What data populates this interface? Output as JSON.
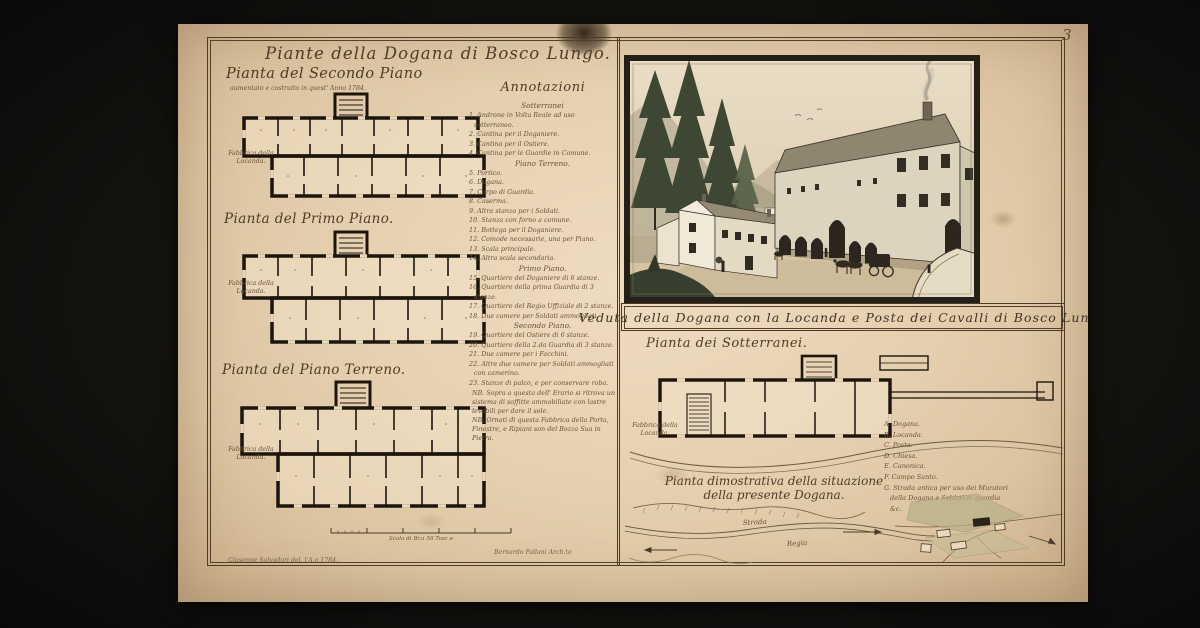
{
  "colors": {
    "backdrop": "#141310",
    "paper": "#e6d2b2",
    "ink": "#1b150e",
    "handwriting": "#6b5136",
    "wash_green": "#3e4634"
  },
  "page": {
    "number": "3"
  },
  "left_panel": {
    "main_title": "Piante della Dogana di Bosco Lungo.",
    "secondo": {
      "title": "Pianta del Secondo Piano",
      "subtitle": "aumentato e costruito in quest' Anno 1784.",
      "margin_label": "Fabbrica della Locanda."
    },
    "primo": {
      "title": "Pianta del Primo Piano.",
      "margin_label": "Fabbrica della Locanda."
    },
    "terreno": {
      "title": "Pianta del Piano Terreno.",
      "margin_label": "Fabbrica della Locanda."
    },
    "annotazioni": {
      "heading": "Annotazioni",
      "lines": [
        {
          "text": "Sotterranei"
        },
        {
          "text": "1. Androne in Volta Reale ad uso sotterraneo."
        },
        {
          "text": "2. Cantina per il Doganiere."
        },
        {
          "text": "3. Cantina per il Ostiere."
        },
        {
          "text": "4. Cantina per le Guardie in Comune."
        },
        {
          "text": "Piano Terreno."
        },
        {
          "text": "5. Portico."
        },
        {
          "text": "6. Dogana."
        },
        {
          "text": "7. Corpo di Guardia."
        },
        {
          "text": "8. Caserma."
        },
        {
          "text": "9. Altra stanza per i Soldati."
        },
        {
          "text": "10. Stanza con forno a comune."
        },
        {
          "text": "11. Bottega per il Doganiere."
        },
        {
          "text": "12. Comode necessarie, una per Piano."
        },
        {
          "text": "13. Scala principale."
        },
        {
          "text": "14. Altra scala secondaria."
        },
        {
          "text": "Primo Piano."
        },
        {
          "text": "15. Quartiere del Doganiere di 6 stanze."
        },
        {
          "text": "16. Quartiere della prima Guardia di 3 stanze."
        },
        {
          "text": "17. Quartiere del Regio Uffiziale di 2 stanze."
        },
        {
          "text": "18. Due camere per Soldati ammogliati."
        },
        {
          "text": "Secondo Piano."
        },
        {
          "text": "19. Quartiere del Ostiere di 6 stanze."
        },
        {
          "text": "20. Quartiere della 2.da Guardia di 3 stanze."
        },
        {
          "text": "21. Due camere per i Facchini."
        },
        {
          "text": "22. Altre due camere per Soldati ammogliati con camerino."
        },
        {
          "text": "23. Stanze di palco, e per conservare roba."
        },
        {
          "text": "NB. Sopra a questa dell' Erario si ritrova un sistema di soffitte ammobiliate con lastre levabili per dare il sole."
        },
        {
          "text": "NB. Ornati di questa Fabbrica della Porta, Finestre, e Ripiani son del Bozza Sua in Pietra."
        }
      ]
    },
    "scale_caption": "Scala di Br.a 50 Tosc.e",
    "signature_left": "Giuseppe Salvadori del. l'A.o 1784.",
    "signature_right": "Bernardo Fallani Arch.to"
  },
  "right_panel": {
    "veduta_caption": "Veduta della Dogana con la Locanda e Posta dei Cavalli di Bosco Lungo",
    "sotterranei": {
      "title": "Pianta dei Sotterranei.",
      "margin_label": "Fabbrica della Locanda."
    },
    "legend": {
      "items": [
        "A. Dogana.",
        "B. Locanda.",
        "C. Posta.",
        "D. Chiesa.",
        "E. Canonica.",
        "F. Campo Santo.",
        "G. Strada antica per uso dei Muratori della Dogana e Soldati di guardia &c."
      ]
    },
    "map": {
      "title_line1": "Pianta dimostrativa della situazione",
      "title_line2": "della presente Dogana.",
      "road_label_1": "Strada",
      "road_label_2": "Regia"
    }
  }
}
